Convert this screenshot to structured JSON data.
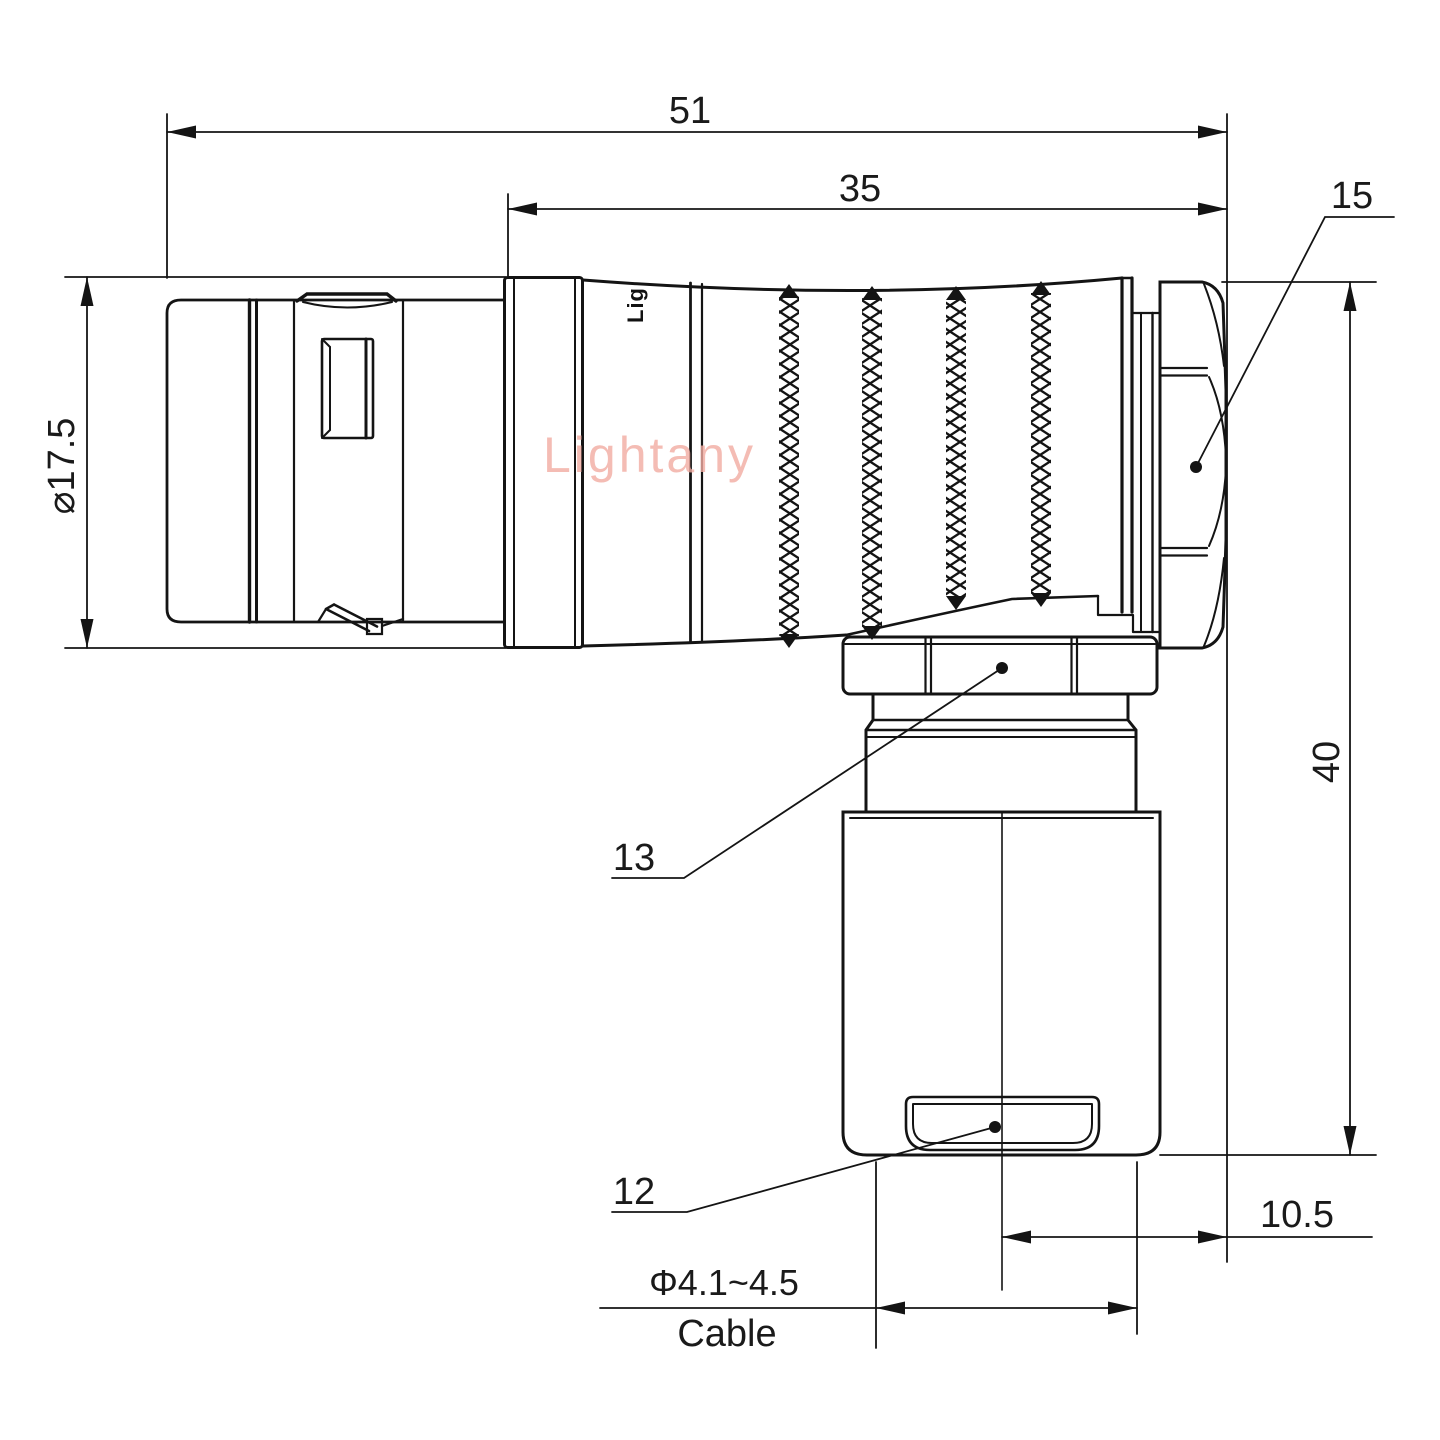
{
  "drawing": {
    "watermark": "Lightany",
    "part_logo": "Lig",
    "dimensions": {
      "overall_length": "51",
      "body_length": "35",
      "nut_size": "15",
      "shell_diameter": "⌀17.5",
      "height": "40",
      "callout_13": "13",
      "callout_12": "12",
      "offset": "10.5",
      "cable_diameter": "Φ4.1~4.5",
      "cable_word": "Cable"
    },
    "colors": {
      "line": "#141414",
      "text": "#1a1a1a",
      "watermark": "#f2aca2",
      "background": "#ffffff"
    }
  }
}
